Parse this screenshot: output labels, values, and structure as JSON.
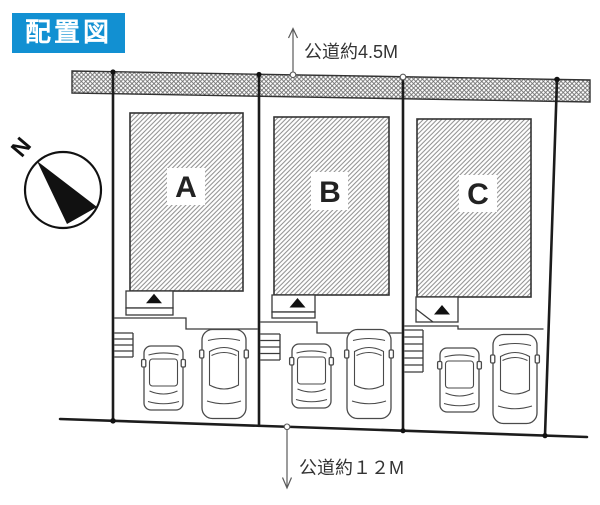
{
  "title": "配置図",
  "compass": {
    "north_label": "N"
  },
  "roads": {
    "top": {
      "label": "公道約4.5M"
    },
    "bottom": {
      "label": "公道約１２M"
    }
  },
  "lots": [
    {
      "label": "A"
    },
    {
      "label": "B"
    },
    {
      "label": "C"
    }
  ],
  "icons": [
    "north-compass-icon",
    "entrance-triangle-icon",
    "stairs-icon",
    "compact-car-icon",
    "sedan-car-icon",
    "up-arrow-icon",
    "down-arrow-icon"
  ],
  "colors": {
    "title_bg": "#1290d2",
    "title_text": "#ffffff",
    "line": "#222222",
    "hatch": "#8a8a8a"
  }
}
